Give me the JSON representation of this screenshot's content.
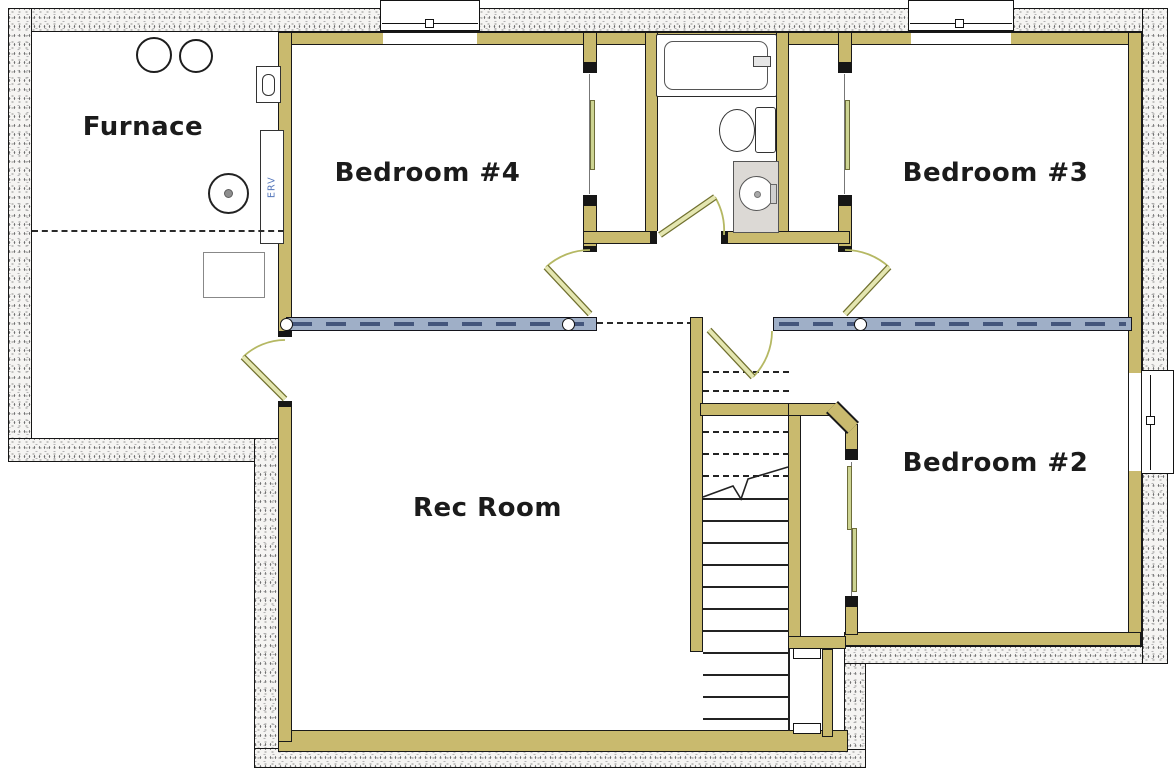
{
  "plan": {
    "type": "floor-plan",
    "rooms": [
      {
        "id": "furnace",
        "label": "Furnace"
      },
      {
        "id": "bedroom-4",
        "label": "Bedroom #4"
      },
      {
        "id": "bedroom-3",
        "label": "Bedroom #3"
      },
      {
        "id": "bedroom-2",
        "label": "Bedroom #2"
      },
      {
        "id": "rec-room",
        "label": "Rec Room"
      }
    ],
    "equipment": {
      "erv_label": "ERV"
    },
    "fixtures": [
      "bathtub",
      "toilet",
      "vanity-sink",
      "water-heater-tank",
      "water-softener-tank",
      "floor-drain",
      "equipment-pad",
      "erv-unit",
      "stairs",
      "window-wells"
    ],
    "colors": {
      "wall_fill": "#C9BA6E",
      "bearing_wall_fill": "#9FAFC7",
      "bearing_wall_dash": "#44567C",
      "door_leaf": "#E4E6B0",
      "door_swing_arc": "#B5B863",
      "closet_door_panel": "#CDD492",
      "vanity_fill": "#DCD9D5",
      "erv_text": "#5577BB",
      "concrete_fill": "#F5F4F2",
      "line": "#1A1A1A"
    }
  }
}
